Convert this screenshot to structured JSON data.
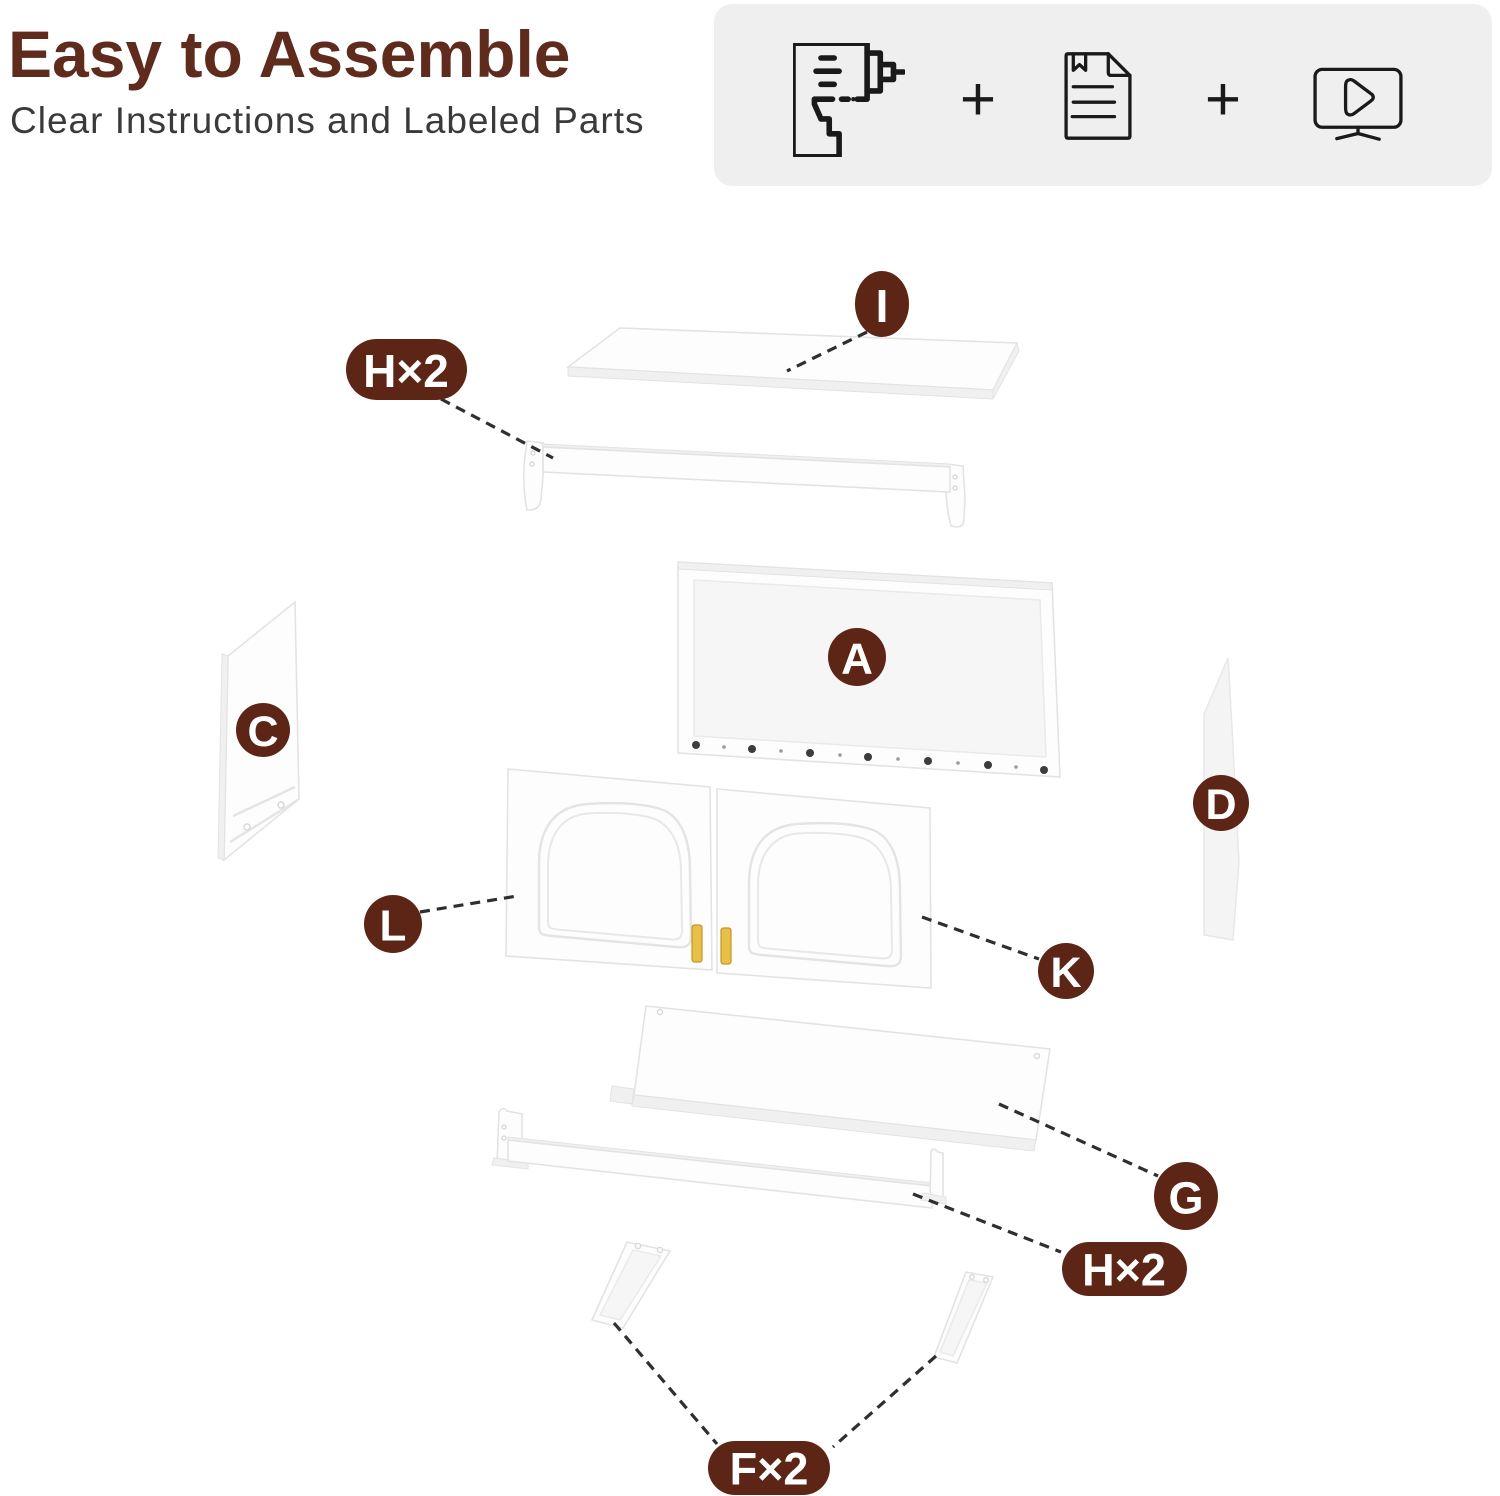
{
  "header": {
    "title": "Easy to Assemble",
    "subtitle": "Clear Instructions and Labeled Parts"
  },
  "feature_box": {
    "plus": "+",
    "items": [
      "power-drill",
      "instruction-manual",
      "video-tutorial"
    ]
  },
  "diagram": {
    "labels": [
      {
        "part": "top-panel",
        "text": "I"
      },
      {
        "part": "hanging-rail-top",
        "text": "H×2"
      },
      {
        "part": "back-panel",
        "text": "A"
      },
      {
        "part": "left-side-panel",
        "text": "C"
      },
      {
        "part": "right-side-panel",
        "text": "D"
      },
      {
        "part": "left-door",
        "text": "L"
      },
      {
        "part": "right-door",
        "text": "K"
      },
      {
        "part": "bottom-shelf",
        "text": "G"
      },
      {
        "part": "hanging-rail-bottom",
        "text": "H×2"
      },
      {
        "part": "mounting-brackets",
        "text": "F×2"
      }
    ]
  },
  "colors": {
    "accent": "#5c2516",
    "title": "#5e2b1d",
    "subtitle": "#3a3a3a",
    "connector": "#2f2f2f",
    "gold": "#e9c046",
    "feature_bg": "#efeff0"
  }
}
